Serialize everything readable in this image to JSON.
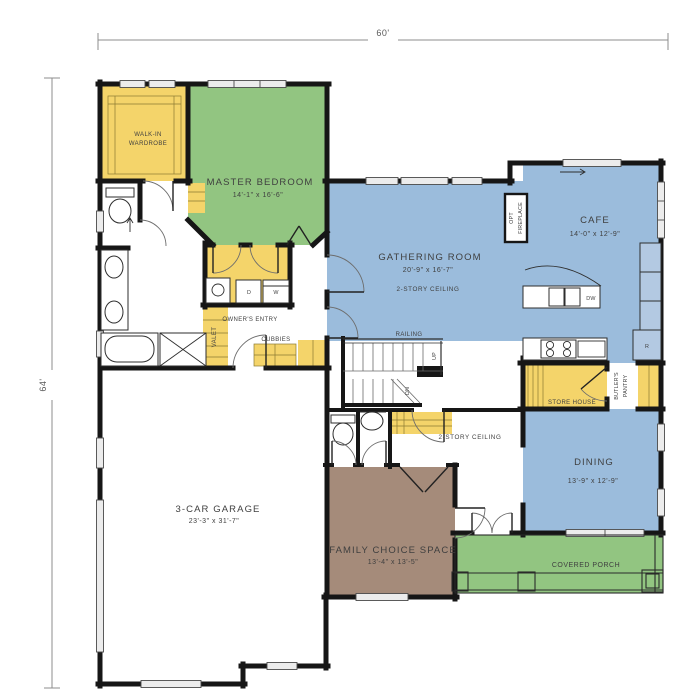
{
  "colors": {
    "room_green": "#92c581",
    "room_blue": "#9bbcdc",
    "cabinet_yellow": "#f4d46a",
    "room_brown": "#a58b7a",
    "appliance_blue": "#b3c9e2",
    "wall": "#161616",
    "dimension_gray": "#8c8c8c"
  },
  "dimensions": {
    "top": "60'",
    "left": "64'"
  },
  "rooms": {
    "walk_in_wardrobe": {
      "line1": "WALK-IN",
      "line2": "WARDROBE"
    },
    "master_bedroom": {
      "name": "MASTER BEDROOM",
      "size": "14'-1\" x 16'-6\""
    },
    "gathering_room": {
      "name": "GATHERING ROOM",
      "size": "20'-9\" x 16'-7\"",
      "note": "2-STORY CEILING"
    },
    "cafe": {
      "name": "CAFE",
      "size": "14'-0\" x 12'-9\""
    },
    "dining": {
      "name": "DINING",
      "size": "13'-9\" x 12'-9\""
    },
    "garage": {
      "name": "3-CAR GARAGE",
      "size": "23'-3\" x 31'-7\""
    },
    "family_choice_space": {
      "name": "FAMILY CHOICE SPACE",
      "size": "13'-4\" x 13'-5\""
    },
    "covered_porch": {
      "name": "COVERED PORCH"
    },
    "foyer": {
      "note": "2-STORY CEILING"
    }
  },
  "features": {
    "owners_entry": "OWNER'S ENTRY",
    "valet": "VALET",
    "cubbies": "CUBBIES",
    "railing": "RAILING",
    "up": "UP",
    "dn": "DN",
    "store_house": "STORE HOUSE",
    "butlers_pantry_line1": "BUTLER'S",
    "butlers_pantry_line2": "PANTRY",
    "opt_fireplace_line1": "OPT",
    "opt_fireplace_line2": "FIREPLACE",
    "washer": "W",
    "dryer": "D",
    "dishwasher": "DW",
    "fridge": "R"
  }
}
